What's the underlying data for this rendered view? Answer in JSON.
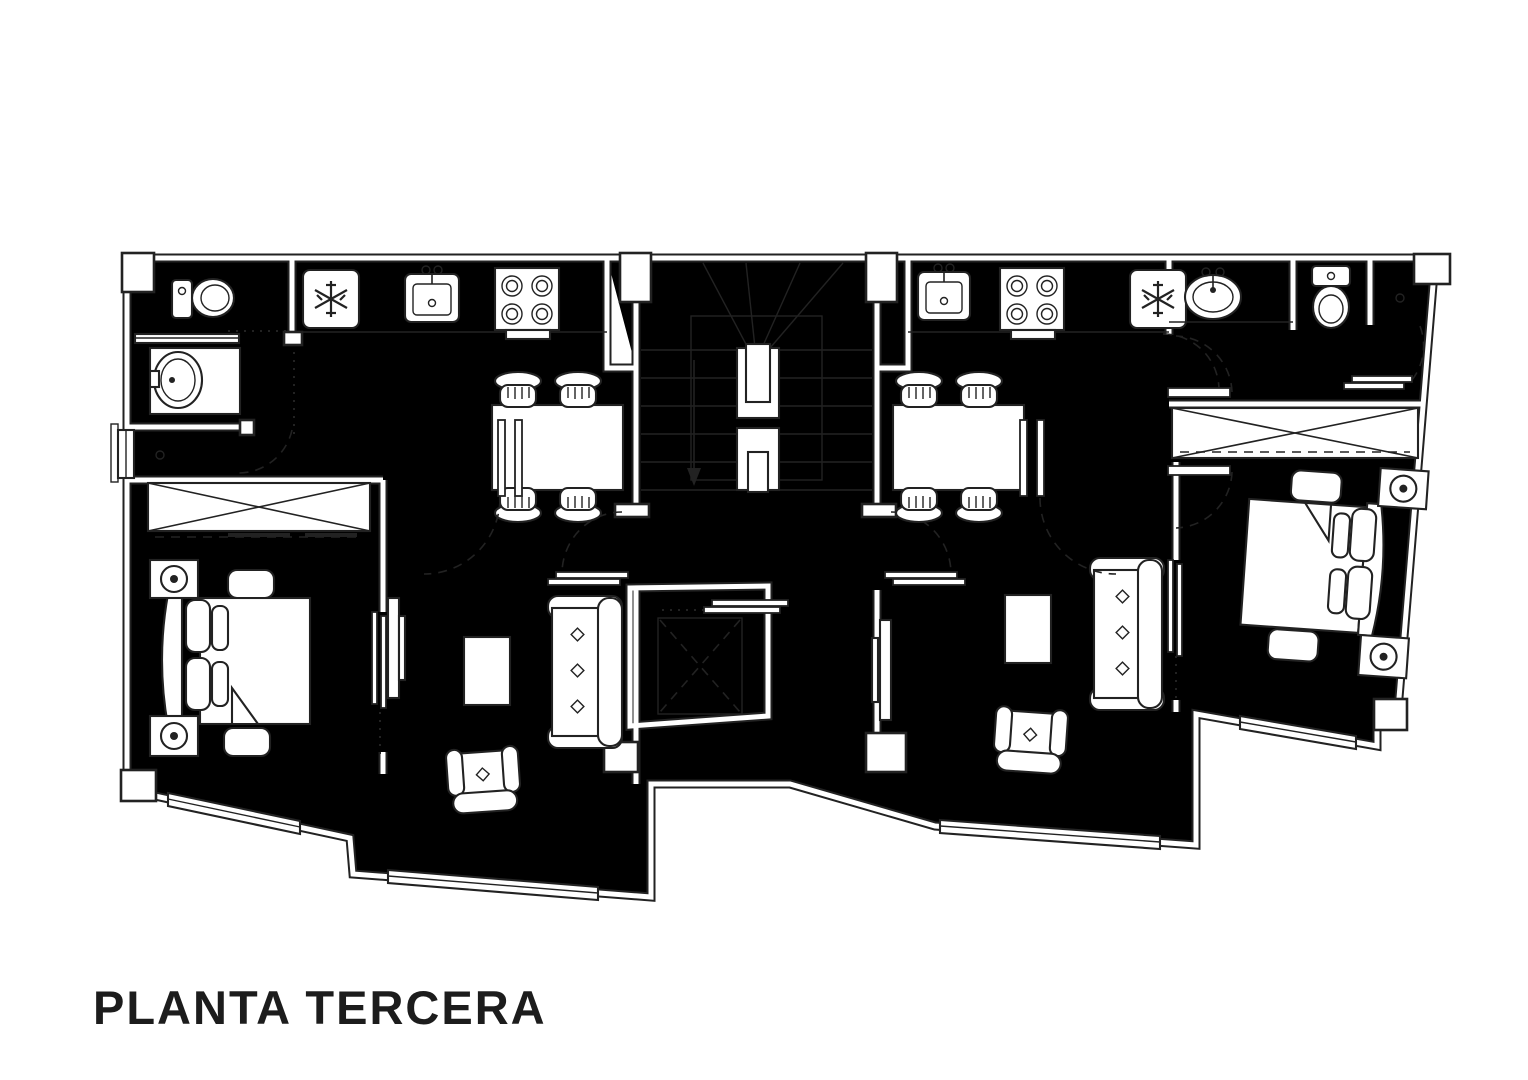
{
  "title": "PLANTA TERCERA",
  "colors": {
    "ink": "#222222",
    "paper": "#ffffff"
  },
  "drawing": {
    "type": "architectural-floor-plan",
    "floor_label": "PLANTA TERCERA",
    "core": {
      "fixtures": [
        "staircase-winder",
        "down-arrow",
        "elevator-cab",
        "landing-doors"
      ]
    },
    "apartment_left": {
      "fixtures": [
        "toilet",
        "vanity-washbasin",
        "refrigerator",
        "kitchen-sink",
        "stove-4-burners",
        "dining-table",
        "chair",
        "chair",
        "chair",
        "chair",
        "sliding-wardrobe",
        "double-bed",
        "nightstand-lamp",
        "nightstand-lamp",
        "tv-panel",
        "sofa",
        "armchair",
        "coffee-table",
        "window",
        "window",
        "door-swing"
      ]
    },
    "apartment_right": {
      "fixtures": [
        "kitchen-sink",
        "stove-4-burners",
        "refrigerator",
        "vanity-washbasin",
        "toilet",
        "sliding-wardrobe",
        "double-bed",
        "nightstand-lamp",
        "nightstand-lamp",
        "dining-table",
        "chair",
        "chair",
        "chair",
        "chair",
        "tv-panel",
        "sofa",
        "armchair",
        "coffee-table",
        "window",
        "window",
        "door-swing"
      ]
    }
  }
}
